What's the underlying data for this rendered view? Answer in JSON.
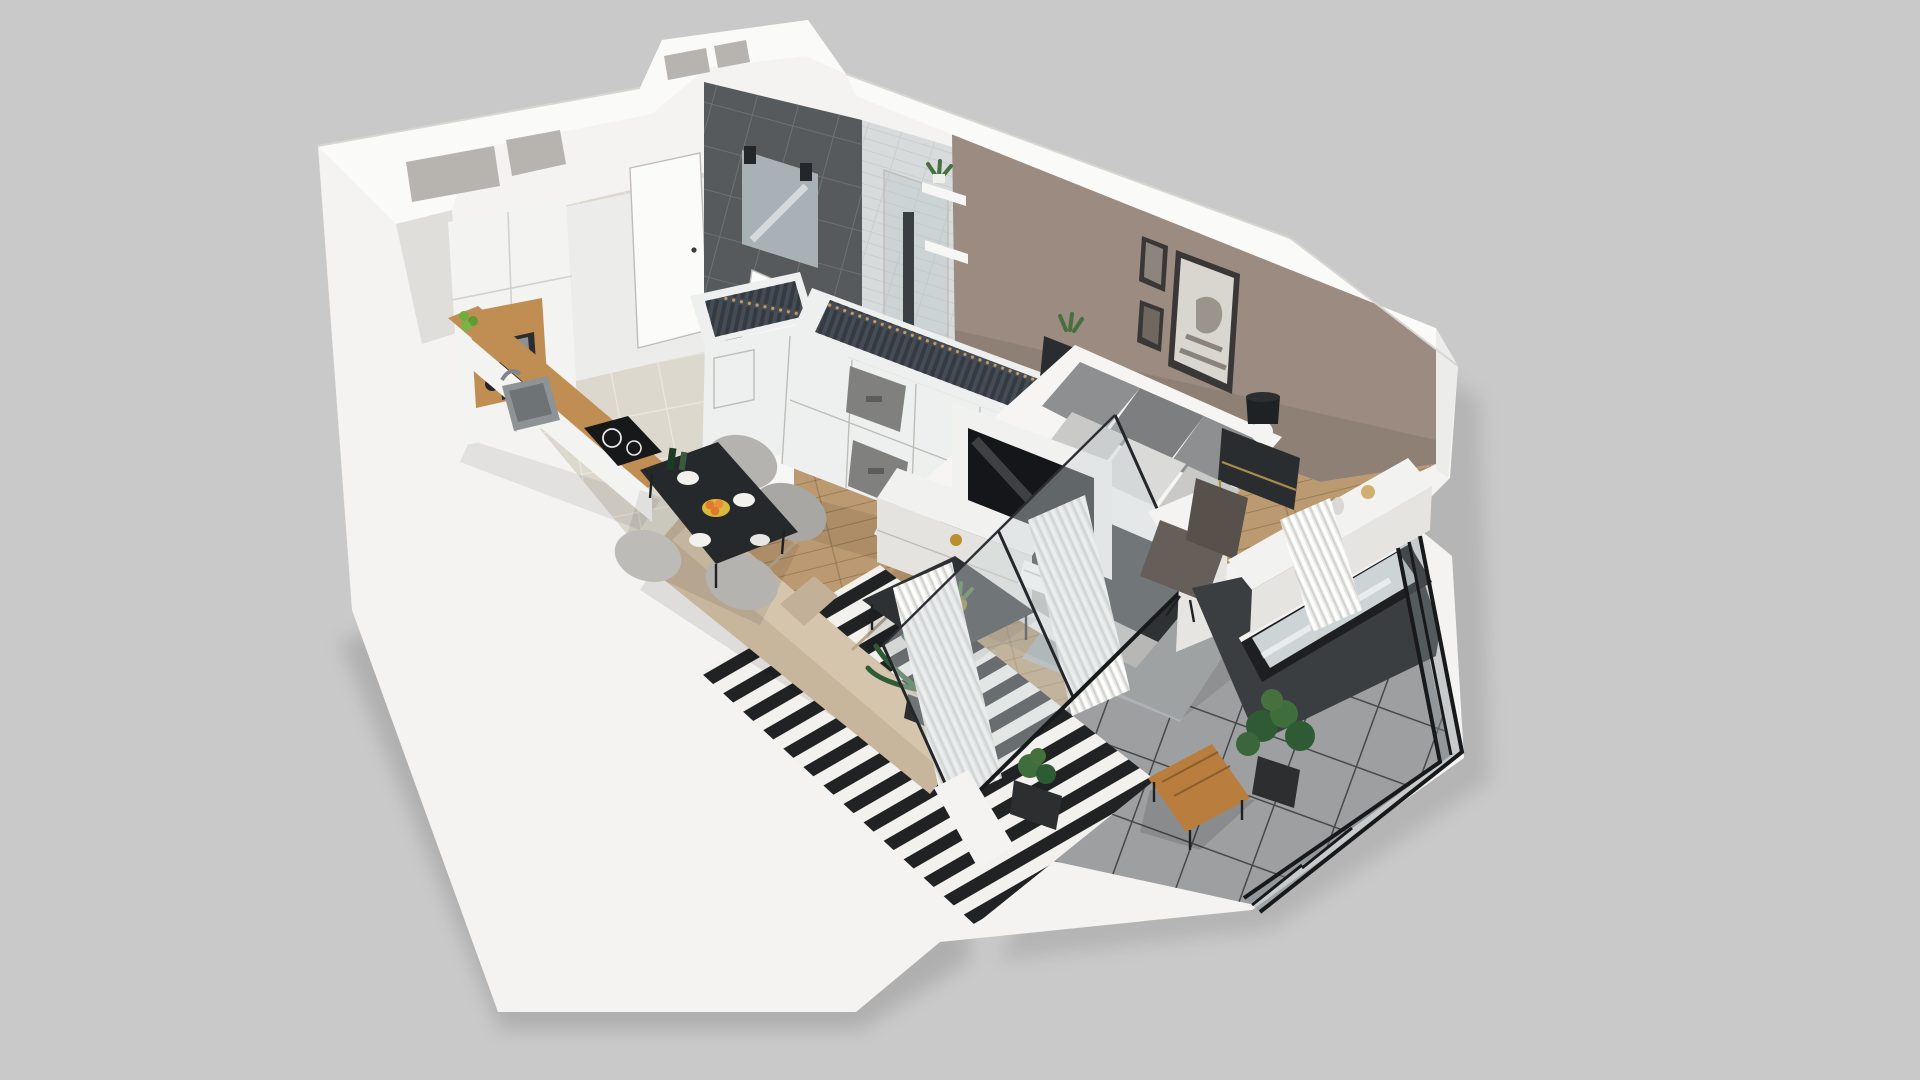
{
  "scene": {
    "type": "3d-floorplan-cutaway-render",
    "description": "Isometric 3D cutaway floor plan of a studio apartment on a plain gray backdrop",
    "rooms": [
      "kitchen",
      "hallway",
      "bathroom",
      "wardrobe",
      "sleeping-area",
      "living-dining-area",
      "workspace",
      "balcony"
    ],
    "objects": [
      "kitchen-cabinets",
      "coffee-machine",
      "sink",
      "cooktop",
      "dining-table",
      "dining-chairs",
      "fruit-bowl",
      "entrance-door",
      "washing-machine",
      "vanity-sink",
      "mirror",
      "shower",
      "wall-shelves",
      "open-wardrobe-with-clothes",
      "storage-boxes",
      "tv-partition",
      "tv-lowboard",
      "double-bed",
      "nightstands",
      "table-lamp",
      "wall-art",
      "sofa",
      "striped-rug",
      "coffee-table",
      "desk",
      "office-chair",
      "window",
      "sliding-glass-doors",
      "sheer-curtains",
      "glass-railing",
      "balcony-table",
      "monstera-plant",
      "palm-plant"
    ]
  },
  "palette": {
    "background": "#c9c9c9",
    "shell_white": "#f4f3f1",
    "wall_top": "#fafaf8",
    "wall_face_light": "#ececea",
    "wall_face_shade": "#e0deda",
    "shaft_gray": "#b7b4af",
    "taupe_wall": "#9c8b80",
    "tile_floor": "#dcd8ce",
    "wood_floor": "#bb9a71",
    "balcony_tile": "#9d9fa0",
    "dark_tile": "#565a5c",
    "white_tile": "#d8dbdc",
    "bathroom_floor": "#515457",
    "door_white": "#fbfbfa",
    "wardrobe_white": "#eef0ef",
    "clothes_dark": "#454c54",
    "hanger_tan": "#c89a62",
    "box_gray": "#80817f",
    "counter_wood": "#c08e52",
    "cabinet_white": "#f3f3f1",
    "cooktop_black": "#17181a",
    "sink_gray": "#8e9496",
    "table_dark": "#26292b",
    "chair_gray": "#b4b3b0",
    "sofa_beige": "#c7b59c",
    "sofa_cushion": "#d5c5ad",
    "rug_white": "#f2f1ee",
    "rug_black": "#202224",
    "coffee_table": "#2e3133",
    "tv_screen": "#141619",
    "tv_unit_white": "#f1f1ef",
    "bed_white": "#f6f5f3",
    "pillow_gray": "#8d8f90",
    "pillow_light": "#c9c9c7",
    "throw_dark": "#2f3234",
    "blanket_gray": "#b7b8b6",
    "nightstand_dark": "#2a2d2f",
    "lamp_shade": "#1f2224",
    "lamp_base": "#f4f4f2",
    "picture_frame": "#3a3836",
    "picture_paper": "#d9d6d0",
    "desk_white": "#f2f2f0",
    "office_chair": "#665f59",
    "window_frame": "#1d1f21",
    "window_glass": "#ccd4d6",
    "balcony_wall_dark": "#3b3e41",
    "railing_glass": "rgba(125,140,145,0.38)",
    "curtain_white": "#e9e9e6",
    "door_glass": "rgba(205,215,218,0.42)",
    "balcony_wood": "#b97e3e",
    "plant_green": "#3f6e3c",
    "pot_dark": "#2c2e30",
    "orange_fruit": "#e07a2a",
    "apple_green": "#6fae3a",
    "bowl_yellow": "#d9b93c",
    "mirror_glass": "#a8b2b6",
    "washer_white": "#f7f7f5",
    "gray_rug": "#aeb2b4",
    "shadow": "rgba(0,0,0,0.10)"
  }
}
